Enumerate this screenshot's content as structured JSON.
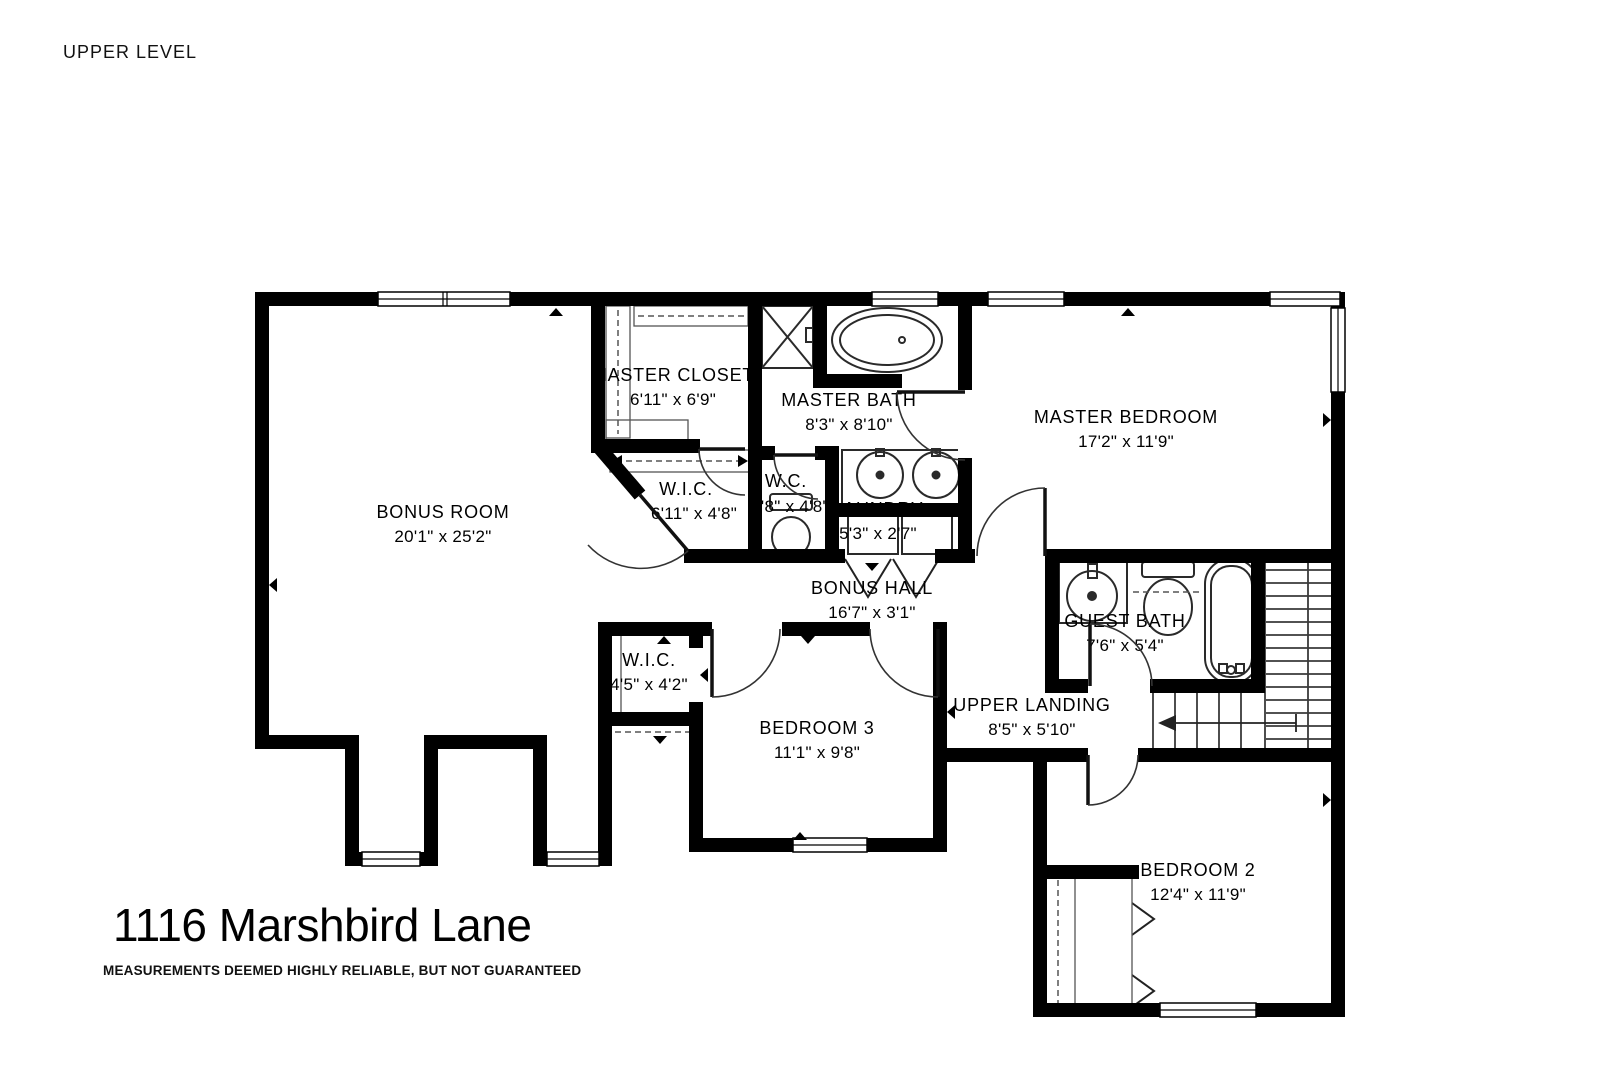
{
  "header": {
    "level_label": "UPPER LEVEL"
  },
  "footer": {
    "title": "1116 Marshbird Lane",
    "disclaimer": "MEASUREMENTS DEEMED HIGHLY RELIABLE, BUT NOT GUARANTEED"
  },
  "rooms": [
    {
      "id": "master-closet",
      "name": "MASTER CLOSET",
      "dims": "6'11\" x 6'9\""
    },
    {
      "id": "master-bath",
      "name": "MASTER BATH",
      "dims": "8'3\" x 8'10\""
    },
    {
      "id": "master-bedroom",
      "name": "MASTER BEDROOM",
      "dims": "17'2\" x 11'9\""
    },
    {
      "id": "bonus-room",
      "name": "BONUS ROOM",
      "dims": "20'1\" x 25'2\""
    },
    {
      "id": "wic-master",
      "name": "W.I.C.",
      "dims": "6'11\" x 4'8\""
    },
    {
      "id": "wc",
      "name": "W.C.",
      "dims": "2'8\" x 4'8\""
    },
    {
      "id": "laundry",
      "name": "LAUNDRY",
      "dims": "5'3\" x 2'7\""
    },
    {
      "id": "bonus-hall",
      "name": "BONUS HALL",
      "dims": "16'7\" x 3'1\""
    },
    {
      "id": "guest-bath",
      "name": "GUEST BATH",
      "dims": "7'6\" x 5'4\""
    },
    {
      "id": "wic-2",
      "name": "W.I.C.",
      "dims": "4'5\" x 4'2\""
    },
    {
      "id": "bedroom-3",
      "name": "BEDROOM 3",
      "dims": "11'1\" x 9'8\""
    },
    {
      "id": "upper-landing",
      "name": "UPPER LANDING",
      "dims": "8'5\" x 5'10\""
    },
    {
      "id": "bedroom-2",
      "name": "BEDROOM 2",
      "dims": "12'4\" x 11'9\""
    }
  ],
  "colors": {
    "wall": "#000000",
    "background": "#ffffff",
    "fixture": "#2a2a2a",
    "text": "#000000"
  }
}
